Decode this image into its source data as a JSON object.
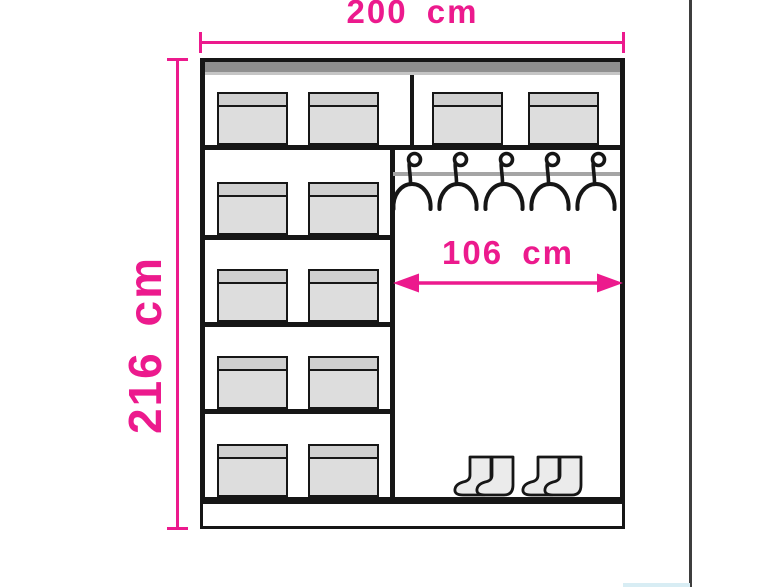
{
  "labels": {
    "width": "200 cm",
    "height": "216 cm",
    "inner_width": "106 cm"
  },
  "colors": {
    "accent": "#EC1A8D",
    "line": "#161616",
    "top_strip": "#8F8F8F",
    "top_strip_edge": "#C5C5C5",
    "box_lid": "#CFCFCF",
    "box_body": "#DDDDDD",
    "rod": "#A5A5A5",
    "boot_fill": "#EBEBEB",
    "side_frame_line": "#3E3E3E",
    "footer_accent": "#D8EDF4"
  },
  "wardrobe": {
    "top_section": {
      "left_boxes": 2,
      "right_boxes": 2
    },
    "left_column": {
      "compartments": 4,
      "boxes_per_compartment": 2
    },
    "hanging_section": {
      "hangers": 5,
      "boot_pairs": 2
    }
  }
}
